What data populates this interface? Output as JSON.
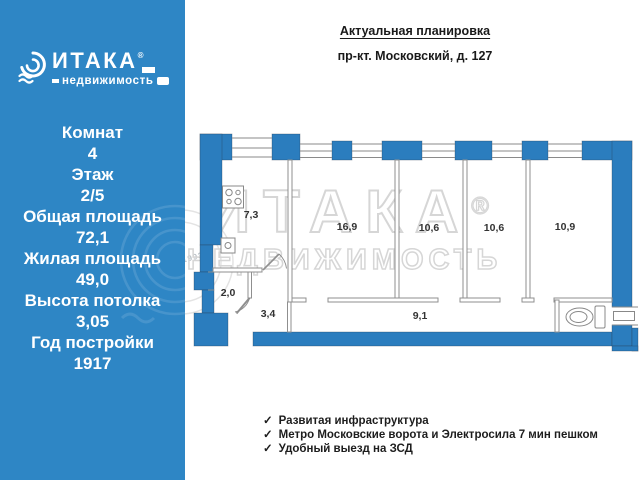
{
  "brand": {
    "name": "ИТАКА",
    "reg": "®",
    "subtitle": "недвижимость"
  },
  "sidebar": {
    "specs": [
      {
        "label": "Комнат",
        "value": "4"
      },
      {
        "label": "Этаж",
        "value": "2/5"
      },
      {
        "label": "Общая площадь",
        "value": "72,1"
      },
      {
        "label": "Жилая площадь",
        "value": "49,0"
      },
      {
        "label": "Высота потолка",
        "value": "3,05"
      },
      {
        "label": "Год постройки",
        "value": "1917"
      }
    ]
  },
  "header": {
    "title": "Актуальная планировка",
    "address": "пр-кт. Московский, д. 127"
  },
  "plan": {
    "rooms": {
      "kitchen": "7,3",
      "room1": "16,9",
      "room2": "10,6",
      "room3": "10,6",
      "room4": "10,9",
      "bath": "2,0",
      "hall": "3,4",
      "corridor": "9,1"
    },
    "watermark": {
      "line1": "ИТАКА",
      "reg": "®",
      "line2": "НЕДВИЖИМОСТЬ",
      "year": "1993"
    }
  },
  "features": [
    {
      "check": "✓",
      "text": "Развитая инфраструктура"
    },
    {
      "check": "✓",
      "text": "Метро Московские ворота и Электросила 7 мин пешком"
    },
    {
      "check": "✓",
      "text": "Удобный выезд на ЗСД"
    }
  ],
  "colors": {
    "sidebar_blue": "#2e86c5",
    "wall_blue": "#2b7dbe",
    "watermark_gray": "#d6d6d6"
  }
}
